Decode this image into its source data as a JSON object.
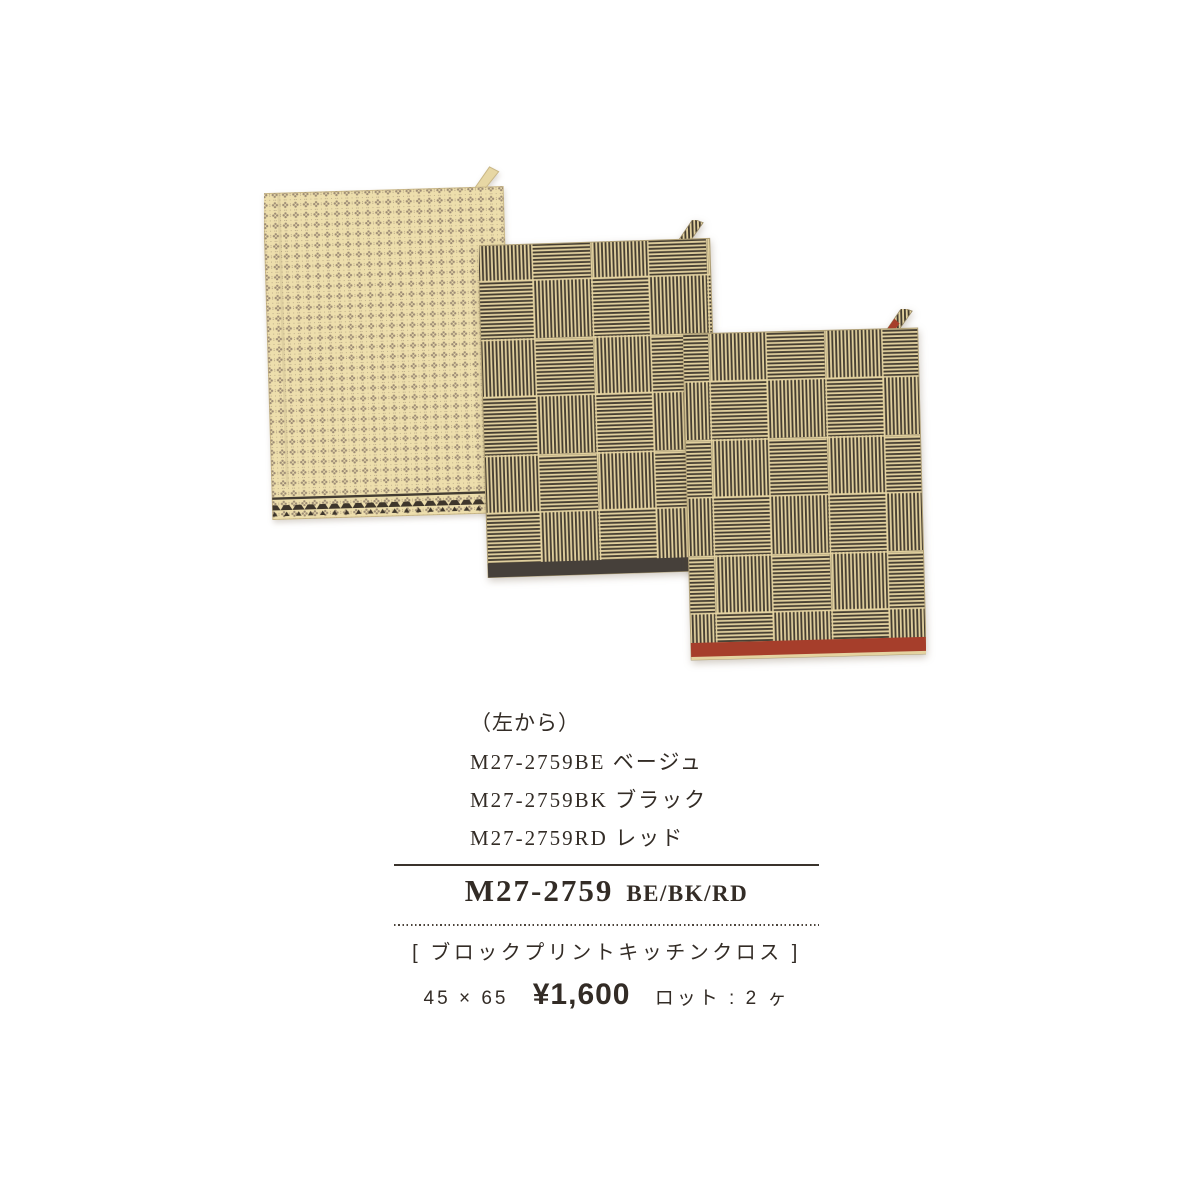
{
  "page": {
    "background": "#ffffff",
    "text_color": "#332c26"
  },
  "caption": {
    "from_left": "（左から）",
    "lines": [
      "M27-2759BE ベージュ",
      "M27-2759BK ブラック",
      "M27-2759RD レッド"
    ]
  },
  "info": {
    "code": "M27-2759",
    "color_codes": "BE/BK/RD",
    "name": "[ ブロックプリントキッチンクロス ]",
    "size": "45 × 65",
    "price": "¥1,600",
    "lot": "ロット : 2 ヶ"
  },
  "products": [
    {
      "variant": "beige",
      "label": "M27-2759BE",
      "cloth_base_hex": "#eddeac",
      "motif_hex": "#8d7b69",
      "border_hex": "#3e362c"
    },
    {
      "variant": "black",
      "label": "M27-2759BK",
      "cloth_base_hex": "#e1d09e",
      "stripe_hex": "#453d31",
      "border_hex": "#46403a"
    },
    {
      "variant": "red",
      "label": "M27-2759RD",
      "cloth_base_hex": "#e1d09e",
      "stripe_hex": "#453d31",
      "border_hex": "#a63e2b"
    }
  ]
}
